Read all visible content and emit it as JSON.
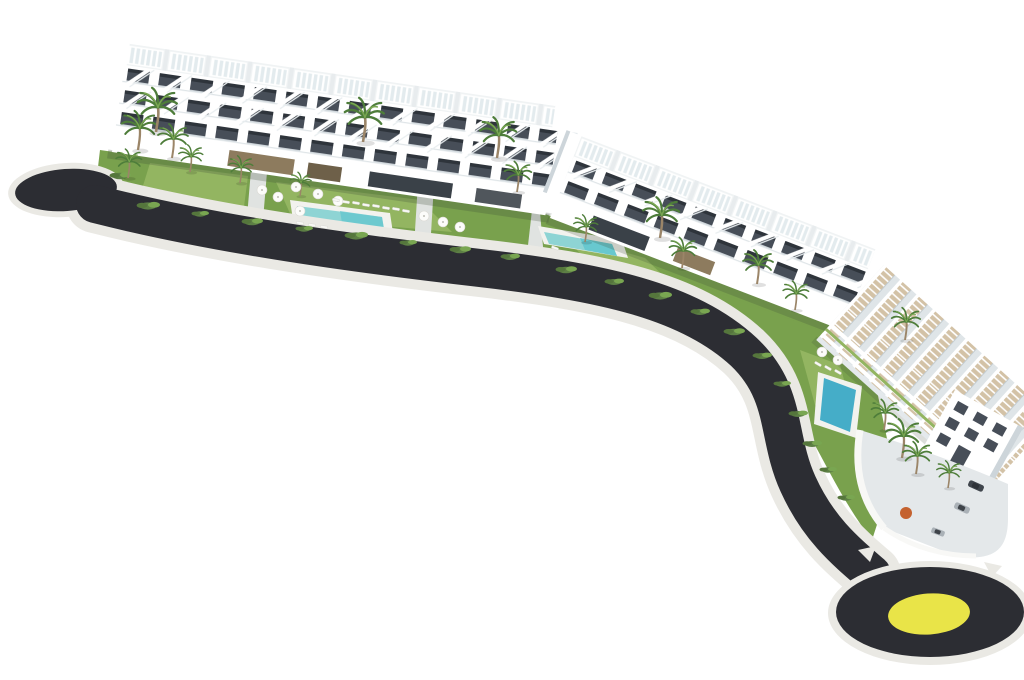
{
  "meta": {
    "title": "Aerial 3D architectural rendering of a white seaside apartment complex with gardens, swimming pools and a curved access road ending in a roundabout with a yellow centre"
  },
  "colors": {
    "background": "#ffffff",
    "asphalt": "#2c2d33",
    "curb": "#eae9e4",
    "promenade": "#efefe9",
    "yellow": "#e9e448",
    "lawn": "#79a14d",
    "lawnLight": "#93b561",
    "lawnDark": "#55763c",
    "poolWater": "#8ed4d4",
    "poolMid": "#5fc4cd",
    "poolDeep": "#45adc8",
    "poolDeck": "#f2f2ee",
    "facadeWhite": "#ffffff",
    "facadeShade": "#e4e9ec",
    "facadeShade2": "#cdd5da",
    "windowDark": "#474e58",
    "windowDarker": "#2e343b",
    "pergolaDeck": "#d3c2a6",
    "earthBrown": "#8d7b5e",
    "glassDark": "#3a4148",
    "palmGreen": "#4e7d3a",
    "palmGreenLight": "#79a651",
    "trunk": "#9b8568",
    "shrub": "#5d7f45",
    "pathGray": "#e0e3e1",
    "carDark": "#3f454c",
    "carLight": "#aab1b7",
    "planterOrange": "#c4622f"
  },
  "scene": {
    "buildings": [
      {
        "id": "building-a",
        "label": "west apartment block with rooftop pergolas and balcony floors"
      },
      {
        "id": "building-b",
        "label": "central apartment block with terraced pergola balconies"
      },
      {
        "id": "building-c",
        "label": "east stepped terrace block descending to entrance facade"
      }
    ],
    "pools": [
      {
        "id": "pool-a",
        "location": "west garden"
      },
      {
        "id": "pool-b",
        "location": "central garden"
      },
      {
        "id": "pool-c",
        "location": "east garden"
      }
    ],
    "road": {
      "surface": "dark asphalt",
      "kerb": "white",
      "west_end": "rounded cul-de-sac bulb",
      "east_end": "roundabout with yellow centre disc"
    },
    "vehicles": {
      "cars": 3,
      "location": "east entrance court"
    },
    "vegetation": {
      "palm_trees": 18,
      "shrub_clusters": 20
    },
    "furniture": {
      "parasols": 11,
      "sun_loungers": 15
    }
  }
}
